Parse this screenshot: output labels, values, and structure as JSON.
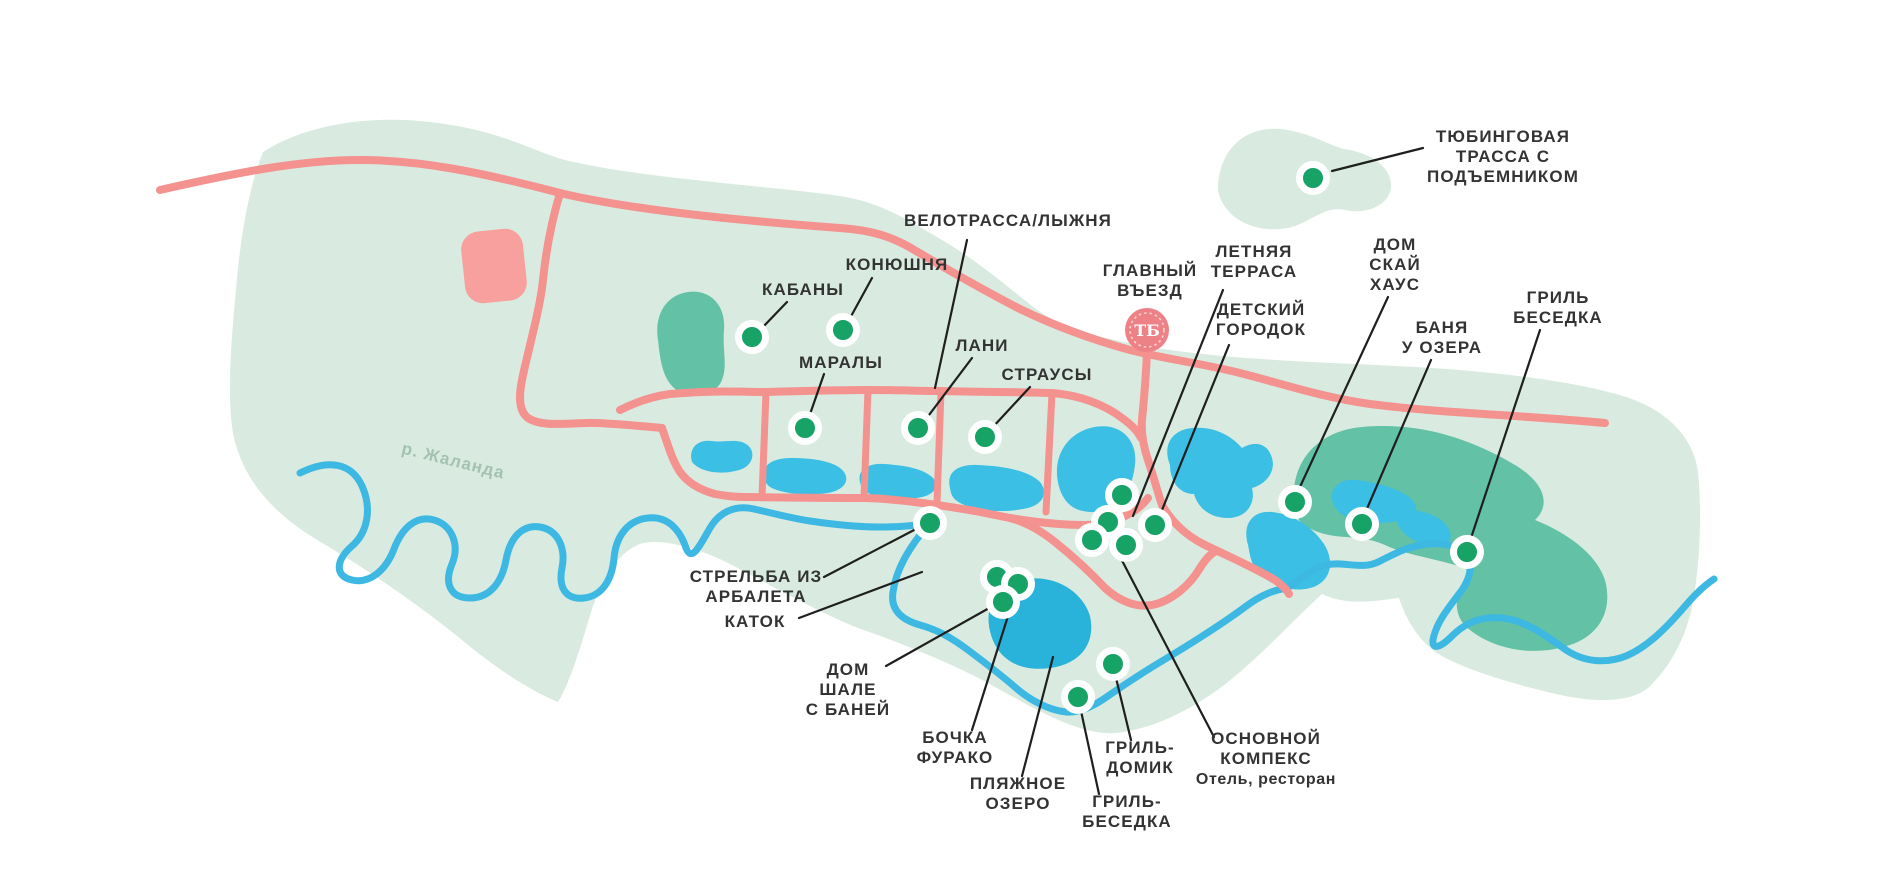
{
  "colors": {
    "background": "#ffffff",
    "land": "#d9ebe0",
    "forest": "#63c1a5",
    "lake": "#3bbfe4",
    "lake_dark": "#29b2da",
    "river": "#3db8e2",
    "road": "#f4928f",
    "building": "#f7a09e",
    "poi_dot": "#17a266",
    "callout_line": "#1f1f1f",
    "label_text": "#333333",
    "logo_fill": "#ed8186",
    "river_label": "#a3c2b2"
  },
  "map": {
    "river_label": {
      "text": "р. Жаланда",
      "x": 452,
      "y": 466,
      "angle": 14
    },
    "entrance": {
      "label_lines": [
        "ГЛАВНЫЙ",
        "ВЪЕЗД"
      ],
      "x": 1150,
      "y": 280,
      "logo_x": 1147,
      "logo_y": 330,
      "logo_r": 22,
      "logo_monogram": "ТБ"
    },
    "dots": [
      {
        "id": "tubing-track",
        "x": 1313,
        "y": 178
      },
      {
        "id": "kabany",
        "x": 752,
        "y": 337
      },
      {
        "id": "konyushnya",
        "x": 843,
        "y": 330
      },
      {
        "id": "maraly",
        "x": 805,
        "y": 428
      },
      {
        "id": "lani",
        "x": 918,
        "y": 428
      },
      {
        "id": "strausy",
        "x": 985,
        "y": 437
      },
      {
        "id": "strelba-iz-arbaleta",
        "x": 930,
        "y": 523
      },
      {
        "id": "furako-1",
        "x": 997,
        "y": 577
      },
      {
        "id": "bochka-furako",
        "x": 1018,
        "y": 584
      },
      {
        "id": "dom-shale",
        "x": 1003,
        "y": 602
      },
      {
        "id": "grill-besedka-south",
        "x": 1078,
        "y": 697
      },
      {
        "id": "grill-domik",
        "x": 1113,
        "y": 664
      },
      {
        "id": "letnyaya-terrasa",
        "x": 1122,
        "y": 495
      },
      {
        "id": "osnovnoy-kompleks",
        "x": 1108,
        "y": 522
      },
      {
        "id": "complex-3",
        "x": 1092,
        "y": 540
      },
      {
        "id": "complex-4",
        "x": 1126,
        "y": 545
      },
      {
        "id": "detskiy-gorodok",
        "x": 1155,
        "y": 525
      },
      {
        "id": "dom-sky-house",
        "x": 1295,
        "y": 502
      },
      {
        "id": "banya-u-ozera",
        "x": 1362,
        "y": 524
      },
      {
        "id": "grill-besedka-east",
        "x": 1467,
        "y": 552
      }
    ],
    "callouts": [
      {
        "id": "tubing-track",
        "lines": [
          "ТЮБИНГОВАЯ",
          "ТРАССА С",
          "ПОДЪЕМНИКОМ"
        ],
        "x": 1503,
        "y": 156,
        "lx1": 1423,
        "ly1": 148,
        "lx2": 1332,
        "ly2": 171
      },
      {
        "id": "velotrassa",
        "lines": [
          "ВЕЛОТРАССА/ЛЫЖНЯ"
        ],
        "x": 1008,
        "y": 220,
        "lx1": 967,
        "ly1": 240,
        "lx2": 935,
        "ly2": 388
      },
      {
        "id": "konyushnya",
        "lines": [
          "КОНЮШНЯ"
        ],
        "x": 897,
        "y": 264,
        "lx1": 872,
        "ly1": 278,
        "lx2": 849,
        "ly2": 320
      },
      {
        "id": "kabany",
        "lines": [
          "КАБАНЫ"
        ],
        "x": 803,
        "y": 289,
        "lx1": 787,
        "ly1": 302,
        "lx2": 762,
        "ly2": 328
      },
      {
        "id": "maraly",
        "lines": [
          "МАРАЛЫ"
        ],
        "x": 841,
        "y": 362,
        "lx1": 824,
        "ly1": 374,
        "lx2": 809,
        "ly2": 417
      },
      {
        "id": "lani",
        "lines": [
          "ЛАНИ"
        ],
        "x": 982,
        "y": 345,
        "lx1": 972,
        "ly1": 358,
        "lx2": 926,
        "ly2": 419
      },
      {
        "id": "strausy",
        "lines": [
          "СТРАУСЫ"
        ],
        "x": 1047,
        "y": 374,
        "lx1": 1030,
        "ly1": 387,
        "lx2": 992,
        "ly2": 428
      },
      {
        "id": "letnyaya-terrasa",
        "lines": [
          "ЛЕТНЯЯ",
          "ТЕРРАСА"
        ],
        "x": 1254,
        "y": 261,
        "lx1": 1223,
        "ly1": 290,
        "lx2": 1133,
        "ly2": 516
      },
      {
        "id": "detskiy-gorodok",
        "lines": [
          "ДЕТСКИЙ",
          "ГОРОДОК"
        ],
        "x": 1261,
        "y": 319,
        "lx1": 1229,
        "ly1": 345,
        "lx2": 1162,
        "ly2": 510
      },
      {
        "id": "dom-sky-house",
        "lines": [
          "ДОМ",
          "СКАЙ",
          "ХАУС"
        ],
        "x": 1395,
        "y": 264,
        "lx1": 1388,
        "ly1": 297,
        "lx2": 1299,
        "ly2": 489
      },
      {
        "id": "banya-u-ozera",
        "lines": [
          "БАНЯ",
          "У ОЗЕРА"
        ],
        "x": 1442,
        "y": 337,
        "lx1": 1431,
        "ly1": 360,
        "lx2": 1366,
        "ly2": 511
      },
      {
        "id": "grill-besedka-east",
        "lines": [
          "ГРИЛЬ",
          "БЕСЕДКА"
        ],
        "x": 1558,
        "y": 307,
        "lx1": 1540,
        "ly1": 330,
        "lx2": 1471,
        "ly2": 538
      },
      {
        "id": "strelba-iz-arbaleta",
        "lines": [
          "СТРЕЛЬБА ИЗ",
          "АРБАЛЕТА"
        ],
        "x": 756,
        "y": 586,
        "lx1": 824,
        "ly1": 577,
        "lx2": 916,
        "ly2": 529
      },
      {
        "id": "katok",
        "lines": [
          "КАТОК"
        ],
        "x": 755,
        "y": 621,
        "lx1": 799,
        "ly1": 618,
        "lx2": 922,
        "ly2": 572
      },
      {
        "id": "dom-shale",
        "lines": [
          "ДОМ",
          "ШАЛЕ",
          "С БАНЕЙ"
        ],
        "x": 848,
        "y": 689,
        "lx1": 886,
        "ly1": 666,
        "lx2": 991,
        "ly2": 607
      },
      {
        "id": "bochka-furako",
        "lines": [
          "БОЧКА",
          "ФУРАКО"
        ],
        "x": 955,
        "y": 747,
        "lx1": 972,
        "ly1": 730,
        "lx2": 1014,
        "ly2": 597
      },
      {
        "id": "plyazhnoe-ozero",
        "lines": [
          "ПЛЯЖНОЕ",
          "ОЗЕРО"
        ],
        "x": 1018,
        "y": 793,
        "lx1": 1022,
        "ly1": 776,
        "lx2": 1053,
        "ly2": 657
      },
      {
        "id": "grill-domik",
        "lines": [
          "ГРИЛЬ-",
          "ДОМИК"
        ],
        "x": 1140,
        "y": 757,
        "lx1": 1131,
        "ly1": 740,
        "lx2": 1116,
        "ly2": 678
      },
      {
        "id": "grill-besedka-south",
        "lines": [
          "ГРИЛЬ-",
          "БЕСЕДКА"
        ],
        "x": 1127,
        "y": 811,
        "lx1": 1099,
        "ly1": 794,
        "lx2": 1081,
        "ly2": 711
      },
      {
        "id": "osnovnoy-kompleks",
        "lines": [
          "ОСНОВНОЙ",
          "КОМПЕКС",
          "Отель, ресторан"
        ],
        "x": 1266,
        "y": 758,
        "lx1": 1214,
        "ly1": 737,
        "lx2": 1116,
        "ly2": 549
      }
    ]
  }
}
